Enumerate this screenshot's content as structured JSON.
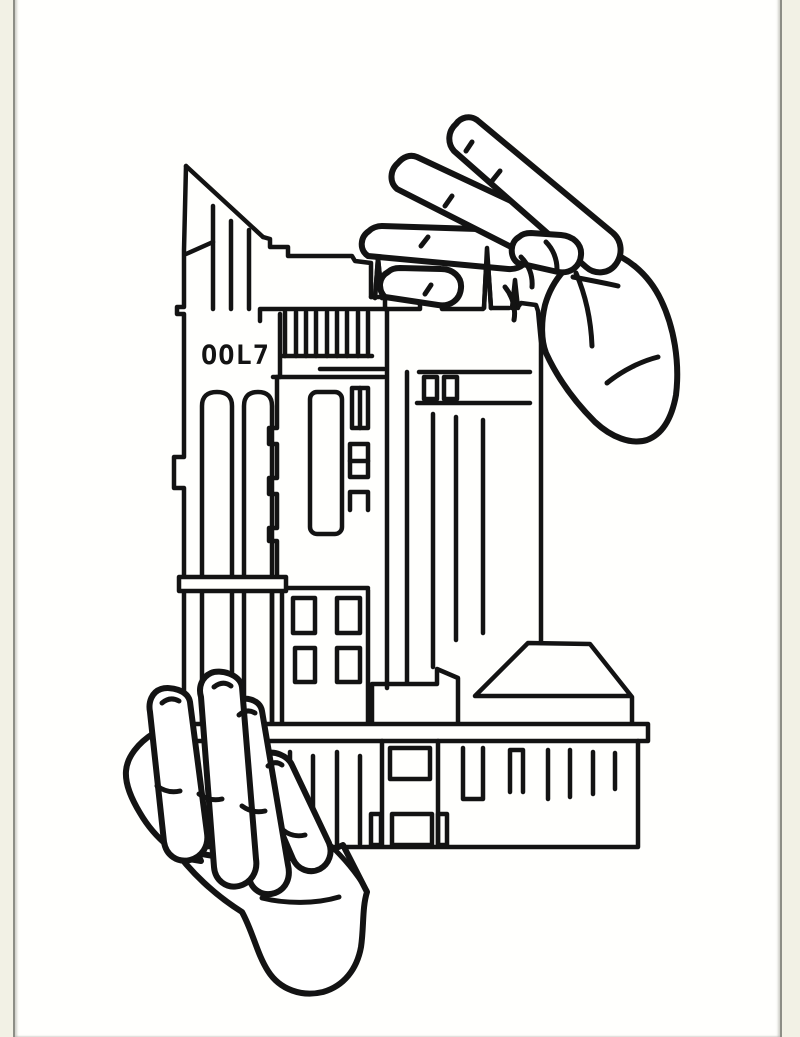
{
  "artwork": {
    "description": "Black ink line drawing of two hands carefully holding a cluster of tall old city buildings; one hand reaches down from the upper right to pinch the rooftops while the other supports the base from the lower left.",
    "sign_text": "OOL7",
    "ink_color": "#131313"
  },
  "page": {
    "paper_color": "#fffffd",
    "margin_color": "#f2f1e5",
    "border_color": "#8d8e86"
  }
}
